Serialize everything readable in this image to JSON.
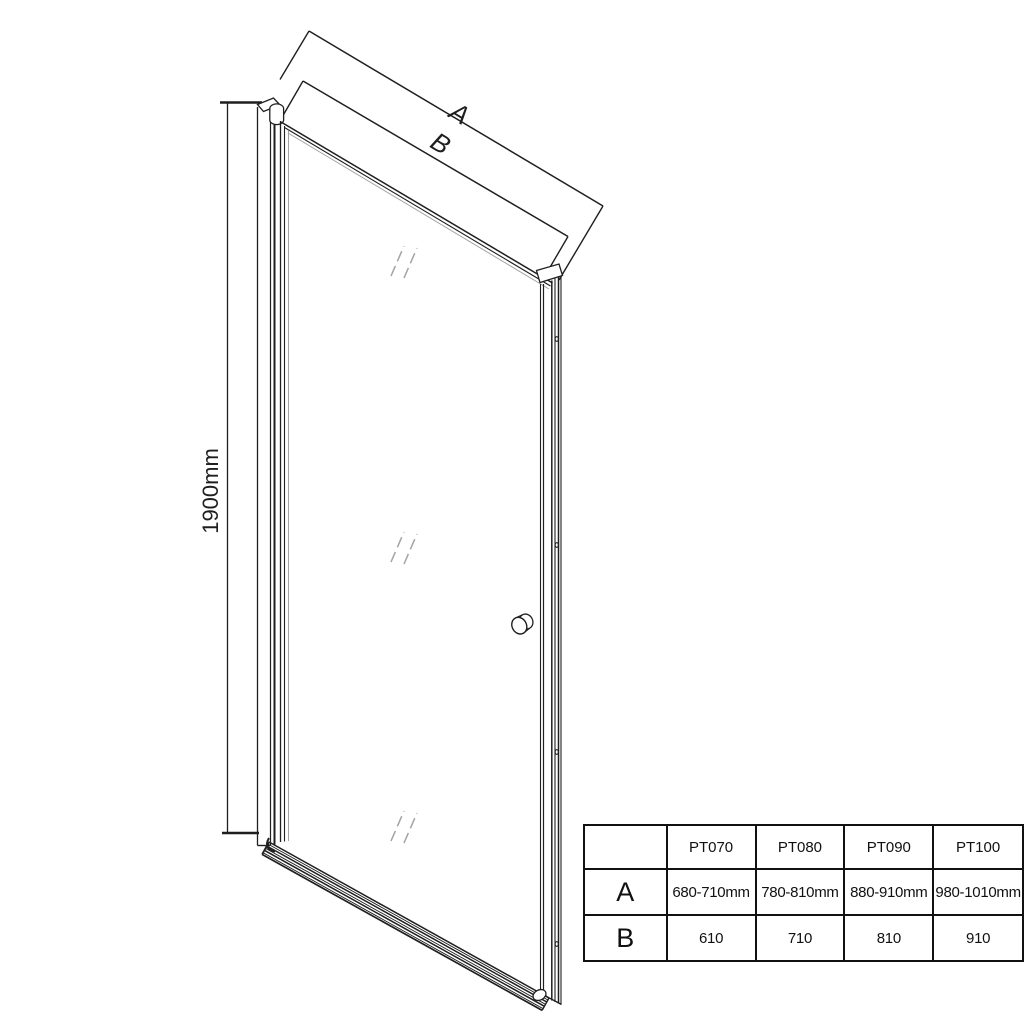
{
  "diagram": {
    "title": "pivot-shower-door-technical-drawing",
    "dim_width_outer_label": "A",
    "dim_width_inner_label": "B",
    "dim_height_label": "1900mm"
  },
  "table": {
    "columns": [
      "PT070",
      "PT080",
      "PT090",
      "PT100"
    ],
    "rows": [
      {
        "label": "A",
        "values": [
          "680-710mm",
          "780-810mm",
          "880-910mm",
          "980-1010mm"
        ]
      },
      {
        "label": "B",
        "values": [
          "610",
          "710",
          "810",
          "910"
        ]
      }
    ]
  },
  "colors": {
    "line": "#1f1f1f",
    "shine": "#a3a3a3",
    "bg": "#ffffff"
  }
}
